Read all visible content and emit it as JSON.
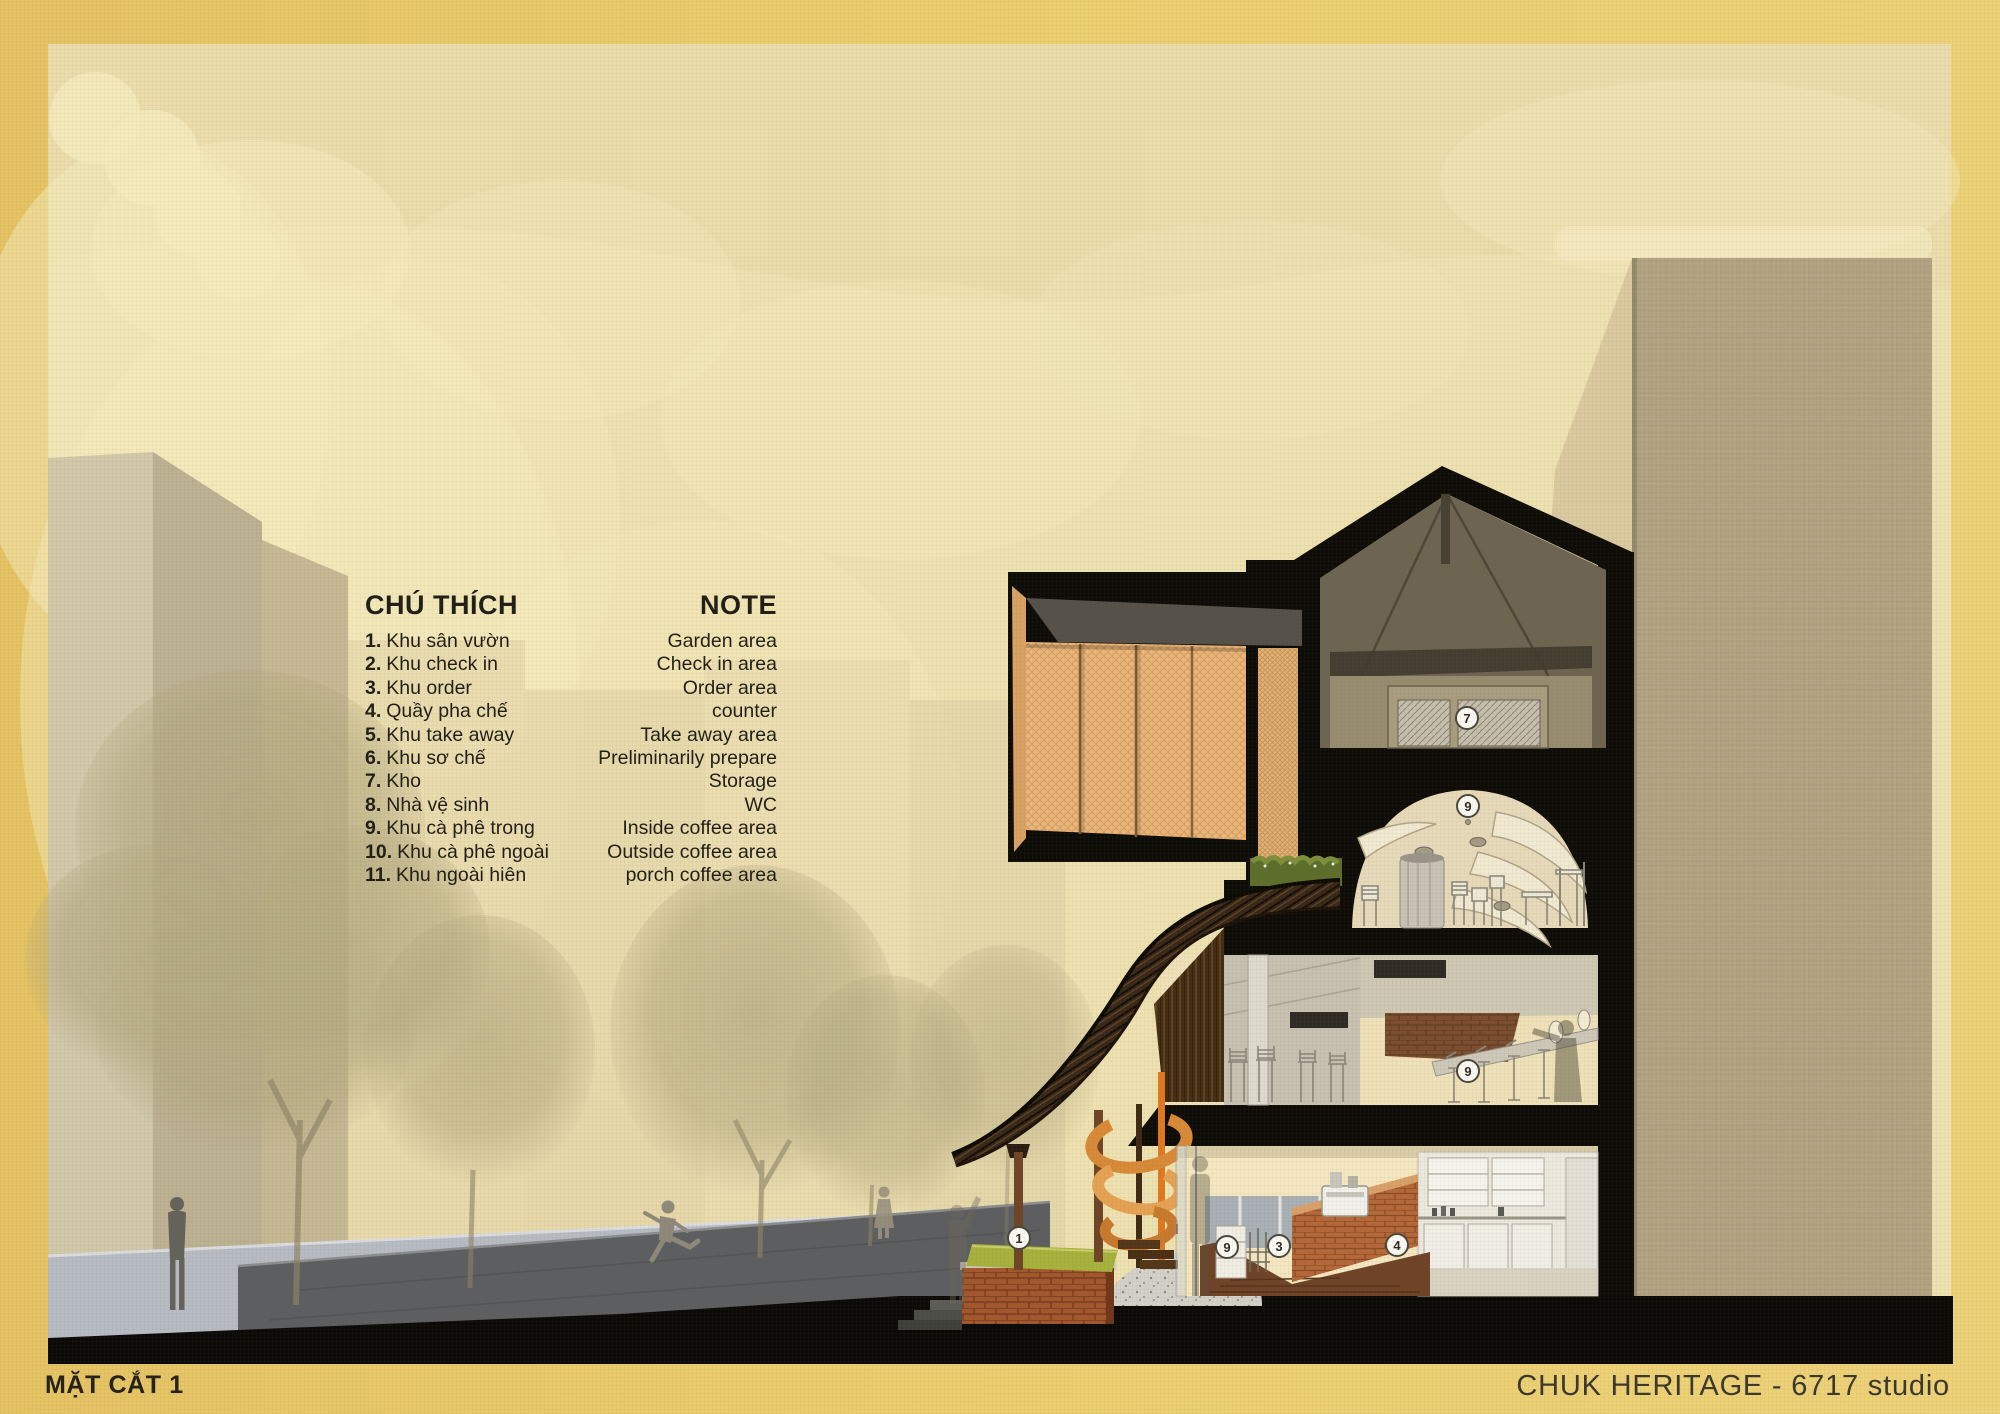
{
  "board": {
    "section_title": "MẶT CẮT 1",
    "credit": "CHUK HERITAGE - 6717 studio"
  },
  "legend": {
    "title_vi": "CHÚ THÍCH",
    "title_en": "NOTE",
    "items": [
      {
        "num": "1.",
        "vi": "Khu sân vườn",
        "en": "Garden area"
      },
      {
        "num": "2.",
        "vi": "Khu check in",
        "en": "Check in area"
      },
      {
        "num": "3.",
        "vi": "Khu order",
        "en": "Order area"
      },
      {
        "num": "4.",
        "vi": "Quầy pha chế",
        "en": "counter"
      },
      {
        "num": "5.",
        "vi": "Khu take away",
        "en": "Take away area"
      },
      {
        "num": "6.",
        "vi": "Khu sơ chế",
        "en": "Preliminarily prepare"
      },
      {
        "num": "7.",
        "vi": "Kho",
        "en": "Storage"
      },
      {
        "num": "8.",
        "vi": "Nhà vệ sinh",
        "en": "WC"
      },
      {
        "num": "9.",
        "vi": "Khu cà phê trong",
        "en": "Inside coffee area"
      },
      {
        "num": "10.",
        "vi": "Khu cà phê ngoài",
        "en": "Outside coffee area"
      },
      {
        "num": "11.",
        "vi": "Khu ngoài hiên",
        "en": "porch coffee area"
      }
    ]
  },
  "annotations": {
    "markers": [
      {
        "num": "7"
      },
      {
        "num": "9"
      },
      {
        "num": "9"
      },
      {
        "num": "1"
      },
      {
        "num": "9"
      },
      {
        "num": "3"
      },
      {
        "num": "4"
      }
    ]
  },
  "colors": {
    "frame_gold": "#eace6e",
    "canvas_cream": "#efe2b2",
    "section_poche": "#0e0c09",
    "timber_orange": "#ecb77c",
    "grass_green": "#a7b23e",
    "brick_red": "#a3572f"
  }
}
